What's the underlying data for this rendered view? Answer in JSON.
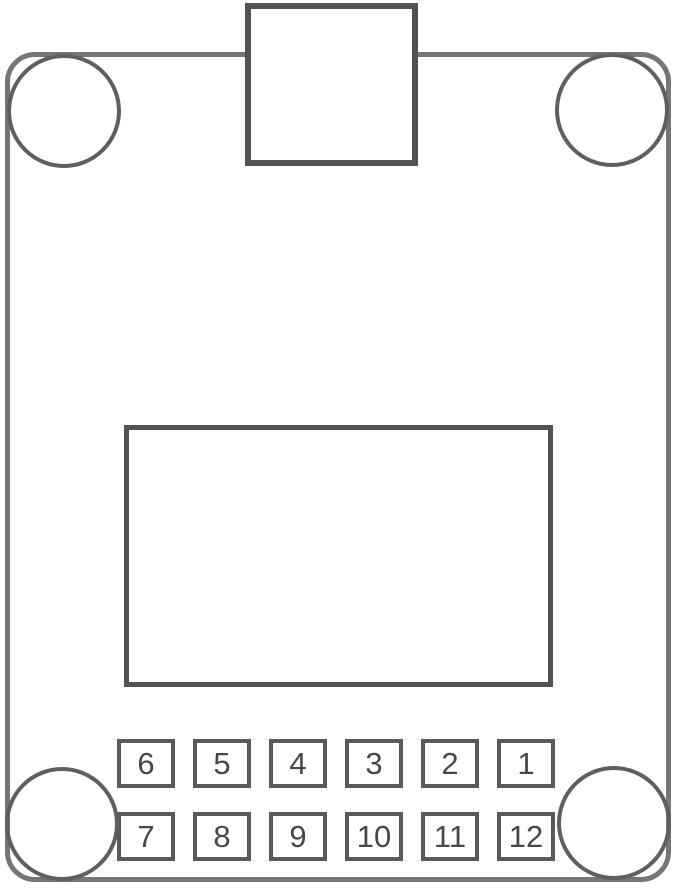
{
  "diagram_type": "pcb-module-outline-drawing",
  "colors": {
    "background": "#ffffff",
    "outline": "#767676",
    "hole_stroke": "#5f5f5f",
    "shape_stroke": "#525252",
    "pin_stroke": "#5a5a5a",
    "pin_text": "#46484c"
  },
  "pins": {
    "top_row": [
      "6",
      "5",
      "4",
      "3",
      "2",
      "1"
    ],
    "bottom_row": [
      "7",
      "8",
      "9",
      "10",
      "11",
      "12"
    ]
  }
}
